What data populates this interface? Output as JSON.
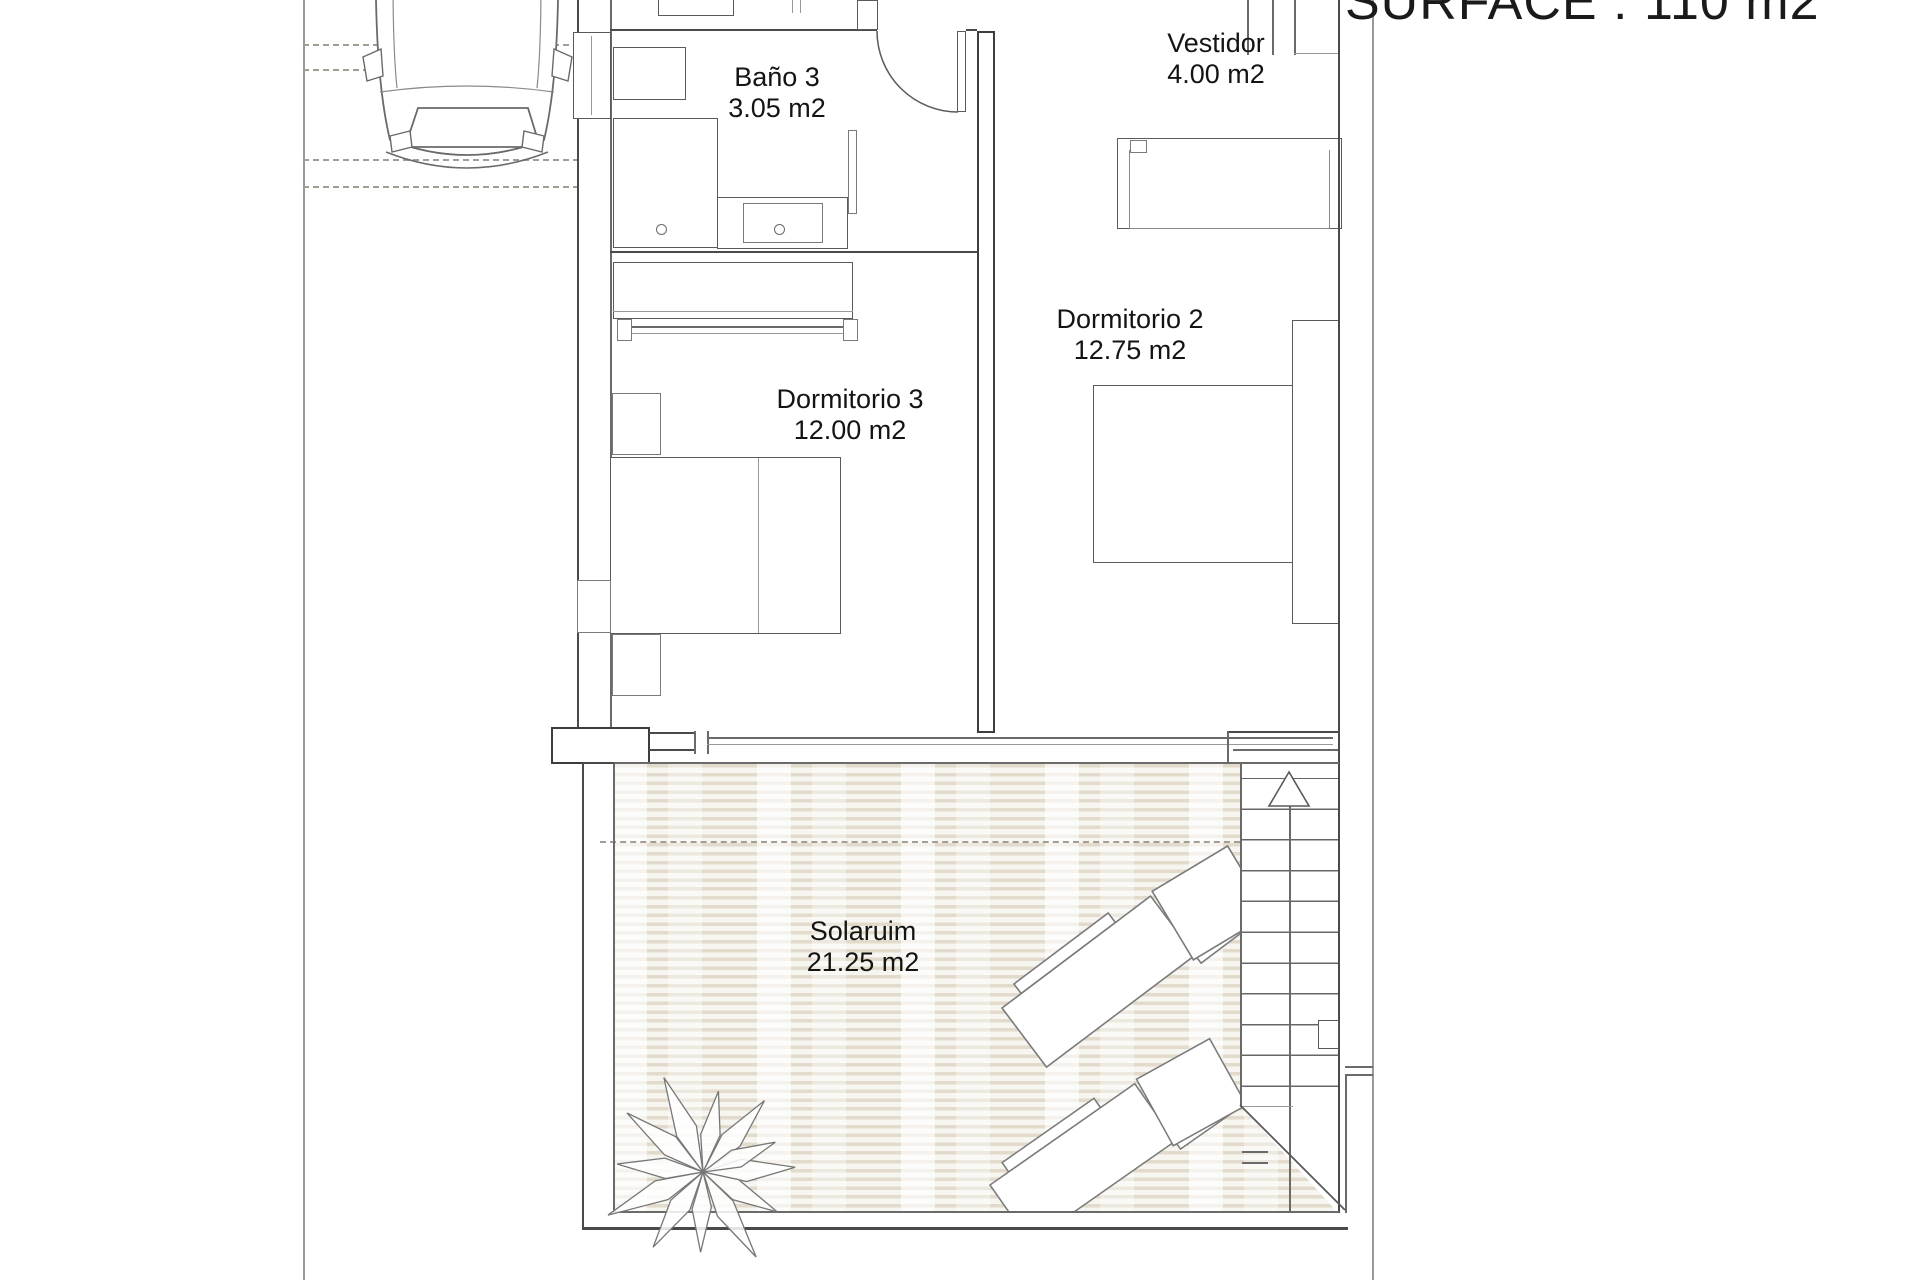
{
  "title": {
    "surface_label": "SURFACE : 110 m2"
  },
  "rooms": {
    "bano3": {
      "name": "Baño 3",
      "area": "3.05 m2"
    },
    "vestidor": {
      "name": "Vestidor",
      "area": "4.00 m2"
    },
    "dormitorio2": {
      "name": "Dormitorio 2",
      "area": "12.75 m2"
    },
    "dormitorio3": {
      "name": "Dormitorio 3",
      "area": "12.00 m2"
    },
    "solarium": {
      "name": "Solaruim",
      "area": "21.25 m2"
    }
  },
  "colors": {
    "wall": "#3d3d3d",
    "line": "#5a5a5a",
    "deck_stripe": "#e2dbcc",
    "deck_base": "#f7f5f0",
    "dashed_line": "#a39e94",
    "text": "#141414"
  },
  "icons": [
    "car-icon",
    "plant-icon",
    "sun-lounger-icon",
    "stairs-up-arrow-icon",
    "door-arc-icon"
  ]
}
